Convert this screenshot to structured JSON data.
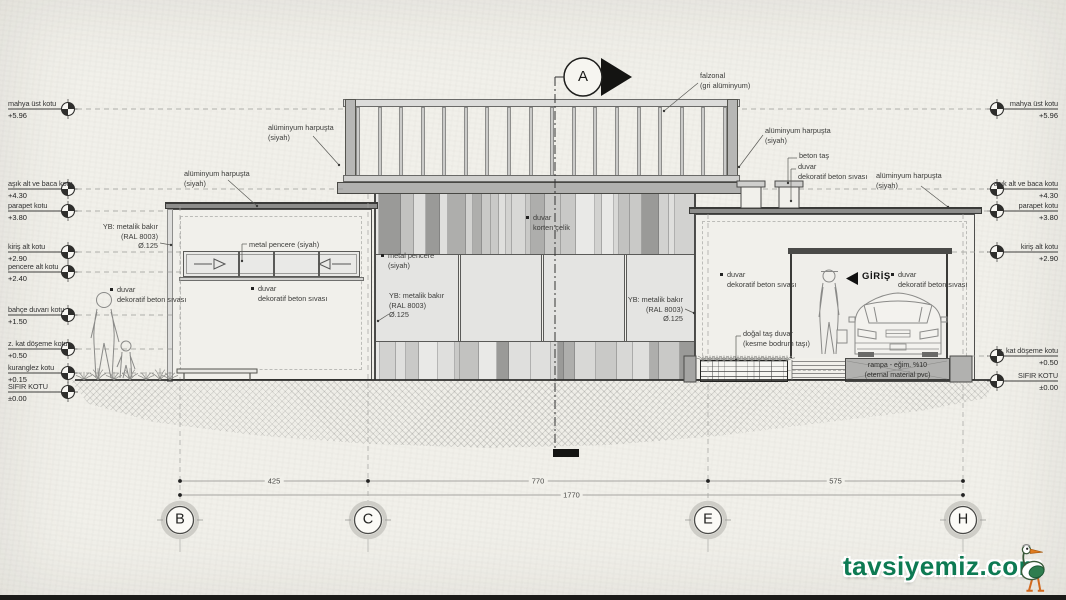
{
  "title": "bina kesiti - A",
  "section_marker": {
    "letter": "A"
  },
  "levels_left": [
    {
      "label": "mahya üst kotu",
      "value": "+5.96",
      "y": 109
    },
    {
      "label": "aşık alt ve baca kotu",
      "value": "+4.30",
      "y": 189
    },
    {
      "label": "parapet kotu",
      "value": "+3.80",
      "y": 211
    },
    {
      "label": "kiriş alt kotu",
      "value": "+2.90",
      "y": 252
    },
    {
      "label": "pencere alt kotu",
      "value": "+2.40",
      "y": 272
    },
    {
      "label": "bahçe duvarı kotu",
      "value": "+1.50",
      "y": 315
    },
    {
      "label": "z. kat döşeme kotu",
      "value": "+0.50",
      "y": 349
    },
    {
      "label": "kuranglez kotu",
      "value": "+0.15",
      "y": 373
    },
    {
      "label": "SIFIR KOTU",
      "value": "±0.00",
      "y": 392
    }
  ],
  "levels_right": [
    {
      "label": "mahya üst kotu",
      "value": "+5.96",
      "y": 109
    },
    {
      "label": "aşık alt ve baca kotu",
      "value": "+4.30",
      "y": 189
    },
    {
      "label": "parapet kotu",
      "value": "+3.80",
      "y": 211
    },
    {
      "label": "kiriş alt kotu",
      "value": "+2.90",
      "y": 252
    },
    {
      "label": "z. kat döşeme kotu",
      "value": "+0.50",
      "y": 356
    },
    {
      "label": "SIFIR KOTU",
      "value": "±0.00",
      "y": 381
    }
  ],
  "annotations": [
    {
      "id": "falzonal",
      "x": 700,
      "y": 71,
      "align": "l",
      "bullet": false,
      "lines": [
        "falzonal",
        "(gri alüminyum)"
      ]
    },
    {
      "id": "alu-harpusta-rail-left",
      "x": 268,
      "y": 123,
      "align": "l",
      "bullet": false,
      "lines": [
        "alüminyum harpuşta",
        "(siyah)"
      ]
    },
    {
      "id": "alu-harpusta-left-bldg",
      "x": 184,
      "y": 169,
      "align": "l",
      "bullet": false,
      "lines": [
        "alüminyum harpuşta",
        "(siyah)"
      ]
    },
    {
      "id": "metal-pencere-left",
      "x": 249,
      "y": 240,
      "align": "l",
      "bullet": false,
      "lines": [
        "metal pencere (siyah)"
      ]
    },
    {
      "id": "yb-bakir-left",
      "x": 158,
      "y": 222,
      "align": "r",
      "bullet": false,
      "lines": [
        "YB: metalik bakır",
        "(RAL 8003)",
        "Ø.125"
      ]
    },
    {
      "id": "duvar-sol-dis",
      "x": 117,
      "y": 285,
      "align": "l",
      "bullet": true,
      "lines": [
        "duvar",
        "dekoratif beton sıvası"
      ]
    },
    {
      "id": "duvar-sol-bina",
      "x": 258,
      "y": 284,
      "align": "l",
      "bullet": true,
      "lines": [
        "duvar",
        "dekoratif beton sıvası"
      ]
    },
    {
      "id": "duvar-korten",
      "x": 533,
      "y": 213,
      "align": "l",
      "bullet": true,
      "lines": [
        "duvar",
        "korten çelik"
      ]
    },
    {
      "id": "metal-pencere-orta",
      "x": 388,
      "y": 251,
      "align": "l",
      "bullet": true,
      "lines": [
        "metal pencere",
        "(siyah)"
      ]
    },
    {
      "id": "yb-bakir-orta",
      "x": 389,
      "y": 291,
      "align": "l",
      "bullet": false,
      "lines": [
        "YB: metalik bakır",
        "(RAL 8003)",
        "Ø.125"
      ]
    },
    {
      "id": "yb-bakir-sag",
      "x": 683,
      "y": 295,
      "align": "r",
      "bullet": false,
      "lines": [
        "YB: metalik bakır",
        "(RAL 8003)",
        "Ø.125"
      ]
    },
    {
      "id": "duvar-sag-ust",
      "x": 727,
      "y": 270,
      "align": "l",
      "bullet": true,
      "lines": [
        "duvar",
        "dekoratif beton sıvası"
      ]
    },
    {
      "id": "beton-tas",
      "x": 799,
      "y": 151,
      "align": "l",
      "bullet": false,
      "lines": [
        "beton taş"
      ]
    },
    {
      "id": "duvar-baca",
      "x": 798,
      "y": 162,
      "align": "l",
      "bullet": false,
      "lines": [
        "duvar",
        "dekoratif beton sıvası"
      ]
    },
    {
      "id": "alu-harpusta-rail-right",
      "x": 765,
      "y": 126,
      "align": "l",
      "bullet": false,
      "lines": [
        "alüminyum harpuşta",
        "(siyah)"
      ]
    },
    {
      "id": "alu-harpusta-sag-bina",
      "x": 876,
      "y": 171,
      "align": "l",
      "bullet": false,
      "lines": [
        "alüminyum harpuşta",
        "(siyah)"
      ]
    },
    {
      "id": "dogal-tas",
      "x": 743,
      "y": 329,
      "align": "l",
      "bullet": false,
      "lines": [
        "doğal taş duvar",
        "(kesme bodrum taşı)"
      ]
    },
    {
      "id": "duvar-giris",
      "x": 898,
      "y": 270,
      "align": "l",
      "bullet": true,
      "lines": [
        "duvar",
        "dekoratif beton sıvası"
      ]
    }
  ],
  "giris": {
    "label": "GİRİŞ"
  },
  "ramp": {
    "line1": "rampa - eğim. %10",
    "line2": "(eternal material pvc)"
  },
  "grid": {
    "bubbles": [
      {
        "label": "B",
        "x": 180
      },
      {
        "label": "C",
        "x": 368
      },
      {
        "label": "E",
        "x": 708
      },
      {
        "label": "H",
        "x": 963
      }
    ],
    "dims": [
      {
        "label": "425",
        "x1": 180,
        "x2": 368
      },
      {
        "label": "770",
        "x1": 368,
        "x2": 708
      },
      {
        "label": "575",
        "x1": 708,
        "x2": 963
      }
    ],
    "total": {
      "label": "1770",
      "x1": 180,
      "x2": 963
    }
  },
  "watermark": {
    "text": "tavsiyemiz.com",
    "color": "#0d7a53"
  }
}
